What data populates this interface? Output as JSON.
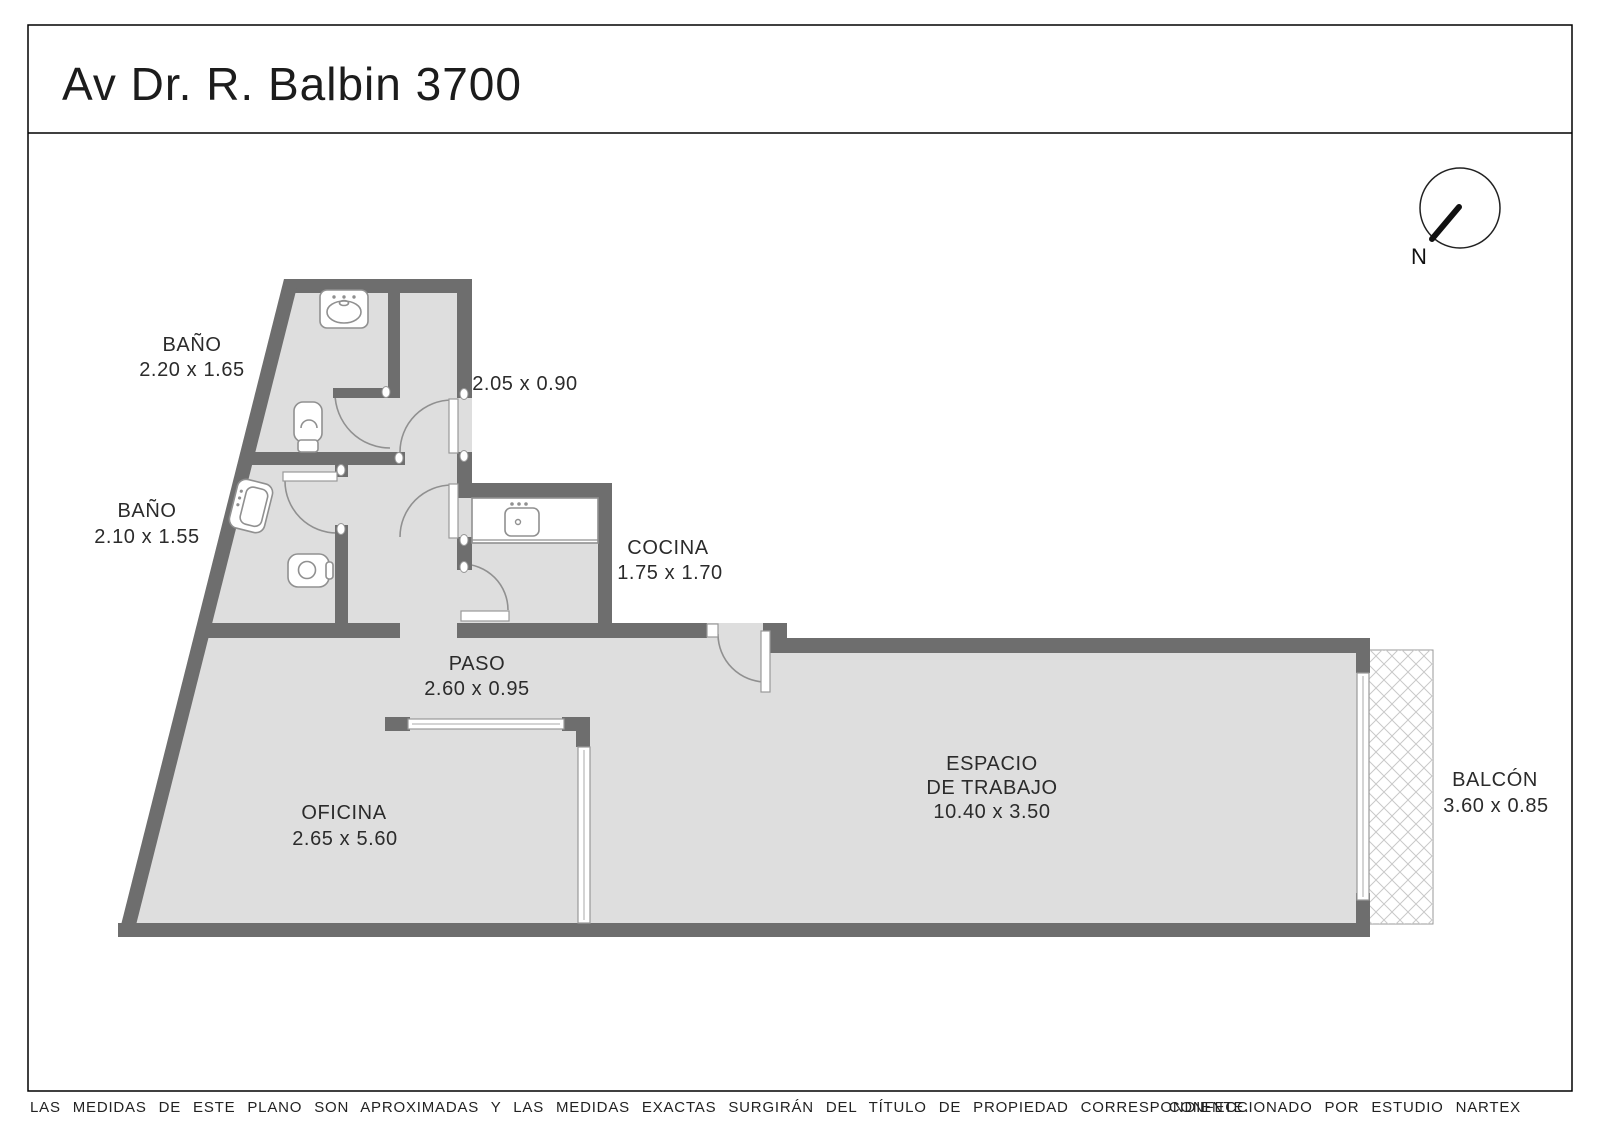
{
  "title": {
    "text": "Av Dr. R. Balbin 3700"
  },
  "compass": {
    "label": "N"
  },
  "rooms": {
    "bano1": {
      "name": "BAÑO",
      "dims": "2.20 x 1.65"
    },
    "bano2": {
      "name": "BAÑO",
      "dims": "2.10 x 1.55"
    },
    "pasillo": {
      "dims": "2.05 x 0.90"
    },
    "cocina": {
      "name": "COCINA",
      "dims": "1.75 x 1.70"
    },
    "paso": {
      "name": "PASO",
      "dims": "2.60 x 0.95"
    },
    "oficina": {
      "name": "OFICINA",
      "dims": "2.65 x 5.60"
    },
    "espacio": {
      "name_line1": "ESPACIO",
      "name_line2": "DE TRABAJO",
      "dims": "10.40 x 3.50"
    },
    "balcon": {
      "name": "BALCÓN",
      "dims": "3.60 x 0.85"
    }
  },
  "footer": {
    "disclaimer": "LAS MEDIDAS  DE ESTE PLANO SON APROXIMADAS Y LAS MEDIDAS EXACTAS SURGIRÁN DEL TÍTULO DE PROPIEDAD CORRESPONDIENTE.",
    "credit": "CONFECCIONADO POR ESTUDIO NARTEX"
  },
  "colors": {
    "wall": "#6e6e6e",
    "floor": "#dedede",
    "outline": "#909090",
    "hatch": "#c9c9c9",
    "ink": "#1c1c1c"
  }
}
